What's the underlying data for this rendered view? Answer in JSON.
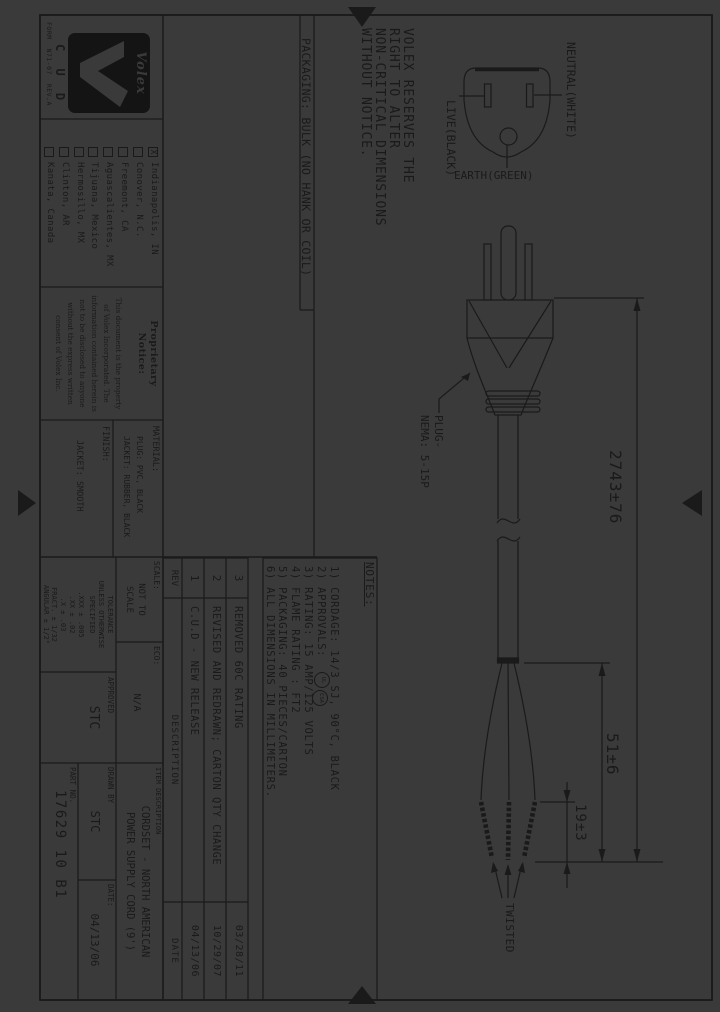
{
  "colors": {
    "paper": "#3a3a3a",
    "ink": "#1a1a1a",
    "logo_bg": "#141414"
  },
  "frame": {
    "form_text": "FORM  N71-07  REV.A"
  },
  "logo": {
    "brand": "Volex",
    "sub": "C U D"
  },
  "locations": {
    "items": [
      {
        "mark": "X",
        "label": "Indianapolis, IN"
      },
      {
        "mark": "",
        "label": "Conover, N.C."
      },
      {
        "mark": "",
        "label": "Freemont, CA"
      },
      {
        "mark": "",
        "label": "Aguascalientes, MX"
      },
      {
        "mark": "",
        "label": "Tijuana, Mexico"
      },
      {
        "mark": "",
        "label": "Hermosillo, MX"
      },
      {
        "mark": "",
        "label": "Clinton, AR"
      },
      {
        "mark": "",
        "label": "Kanata, Canada"
      }
    ]
  },
  "proprietary": {
    "title_line1": "Proprietary",
    "title_line2": "Notice:",
    "lines": [
      "This document is the property",
      "of Volex Incorporated. The",
      "information contained herein is",
      "not to be disclosed to anyone",
      "without the express written",
      "consent of Volex Inc."
    ]
  },
  "material": {
    "label": "MATERIAL:",
    "line1": "PLUG: PVC, BLACK",
    "line2": "JACKET: RUBBER, BLACK",
    "finish_label": "FINISH:",
    "finish_value": "JACKET: SMOOTH"
  },
  "tolerance": {
    "line1": "TOLERANCE",
    "line2": "UNLESS OTHERWISE",
    "line3": "SPECIFIED",
    "vals": [
      ".XXX ± .005",
      ".XX ± .02",
      ".X ± .03",
      "FRACT. ± 1/32",
      "ANGULAR ± 1/2°"
    ]
  },
  "scale_block": {
    "scale_label": "SCALE:",
    "scale_line1": "NOT TO",
    "scale_line2": "SCALE",
    "eco_label": "ECO:",
    "eco_value": "N/A"
  },
  "approval_block": {
    "approved_label": "APPROVED",
    "approved_value": "STC"
  },
  "title_block": {
    "item_label": "ITEM DESCRIPTION",
    "desc_line1": "CORDSET - NORTH AMERICAN",
    "desc_line2": "POWER SUPPLY CORD (9')",
    "drawn_label": "DRAWN BY",
    "drawn_value": "STC",
    "date_label": "DATE:",
    "date_value": "04/13/06",
    "part_label": "PART NO.",
    "part_number": "17629 10 B1"
  },
  "rev_table": {
    "rev_header": "REV",
    "desc_header": "DESCRIPTION",
    "date_header": "DATE",
    "rows": [
      {
        "rev": "3",
        "desc": "REMOVED 60C RATING",
        "date": "03/28/11"
      },
      {
        "rev": "2",
        "desc": "REVISED AND REDRAWN; CARTON QTY CHANGE",
        "date": "10/29/07"
      },
      {
        "rev": "1",
        "desc": "C.U.D - NEW RELEASE",
        "date": "04/13/06"
      }
    ]
  },
  "notes": {
    "title": "NOTES:",
    "item1": "1) CORDAGE: 14/3 SJ, 90°C, BLACK",
    "item2": "2) APPROVALS:",
    "mark1": "UL",
    "mark2": "CSA",
    "item3": "3) RATING: 15 AMP/125 VOLTS",
    "item4": "4) FLAME RATING : FT2",
    "item5": "5) PACKAGING: 40 PIECES/CARTON",
    "item6": "6) ALL DIMENSIONS IN MILLIMETERS."
  },
  "statements": {
    "line1": "VOLEX RESERVES THE",
    "line2": "RIGHT TO ALTER",
    "line3": "NON-CRITICAL DIMENSIONS",
    "line4": "WITHOUT NOTICE.",
    "packaging": "PACKAGING: BULK (NO HANK OR COIL)"
  },
  "plug": {
    "neutral": "NEUTRAL(WHITE)",
    "live": "LIVE(BLACK)",
    "earth": "EARTH(GREEN)",
    "type_line1": "PLUG-",
    "type_line2": "NEMA: 5-15P"
  },
  "dims": {
    "length": "2743±76",
    "strip": "51±6",
    "twist": "19±3",
    "twisted": "TWISTED"
  }
}
